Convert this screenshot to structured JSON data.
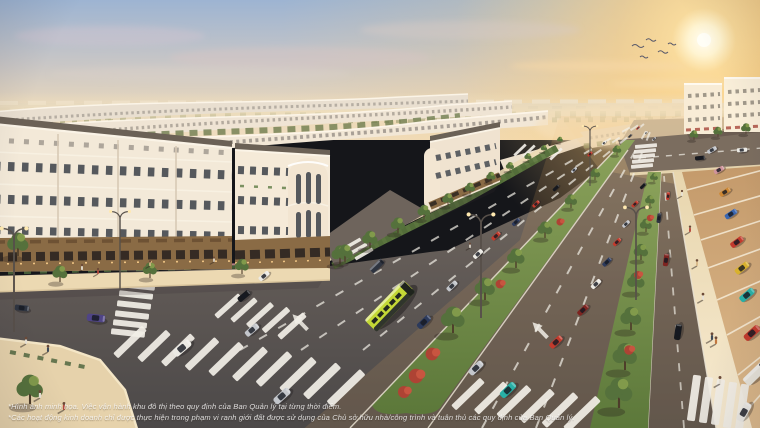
{
  "disclaimer": {
    "line1": "*Hình ảnh minh họa. Việc vận hành khu đô thị theo quy định của Ban Quản lý tại từng thời điểm.",
    "line2": "*Các hoạt động kinh doanh chỉ được thực hiện trong phạm vi ranh giới đất được sử dụng của Chủ sở hữu nhà/công trình và tuân thủ các quy định của Ban Quản lý."
  },
  "palette": {
    "skyTop": "#9db4d2",
    "skyWarm": "#f0ddbe",
    "sunGlow": "#ffd98f",
    "sunCore": "#fffdf4",
    "facadeLight": "#f3e9d8",
    "facadeShade": "#e6d8c4",
    "roofTone": "#6b6156",
    "storefrontBronze": "#8a6b45",
    "windowDark": "#3a4048",
    "asphaltDark": "#4b4848",
    "sidewalkWarm": "#ecd9b2",
    "parkingGround": "#cfa97a",
    "grassLight": "#8ba25b",
    "grassDark": "#5c783a",
    "treeGreen": "#55713c",
    "treeHi": "#8aa14e",
    "treeOlive": "#6f7d4f",
    "flowerRed": "#ae4334",
    "laneWhite": "#f2efe7",
    "curbWhite": "#e9e2d2",
    "busGreen": "#c3d836",
    "carRed": "#c23a2c",
    "carTeal": "#28b0a6",
    "carNavy": "#2c3a5c",
    "carPurple": "#4f4486",
    "carSilver": "#c3c6cb",
    "carWhite": "#eceae4",
    "carBlack": "#17191e",
    "carOrange": "#cd8733",
    "carPink": "#cf939b",
    "carBlue": "#3a66b0",
    "carYellow": "#d8b12e",
    "carDarkRed": "#7e2420",
    "carDarkGrey": "#2e3440",
    "vanWhite": "#e8e4da"
  }
}
